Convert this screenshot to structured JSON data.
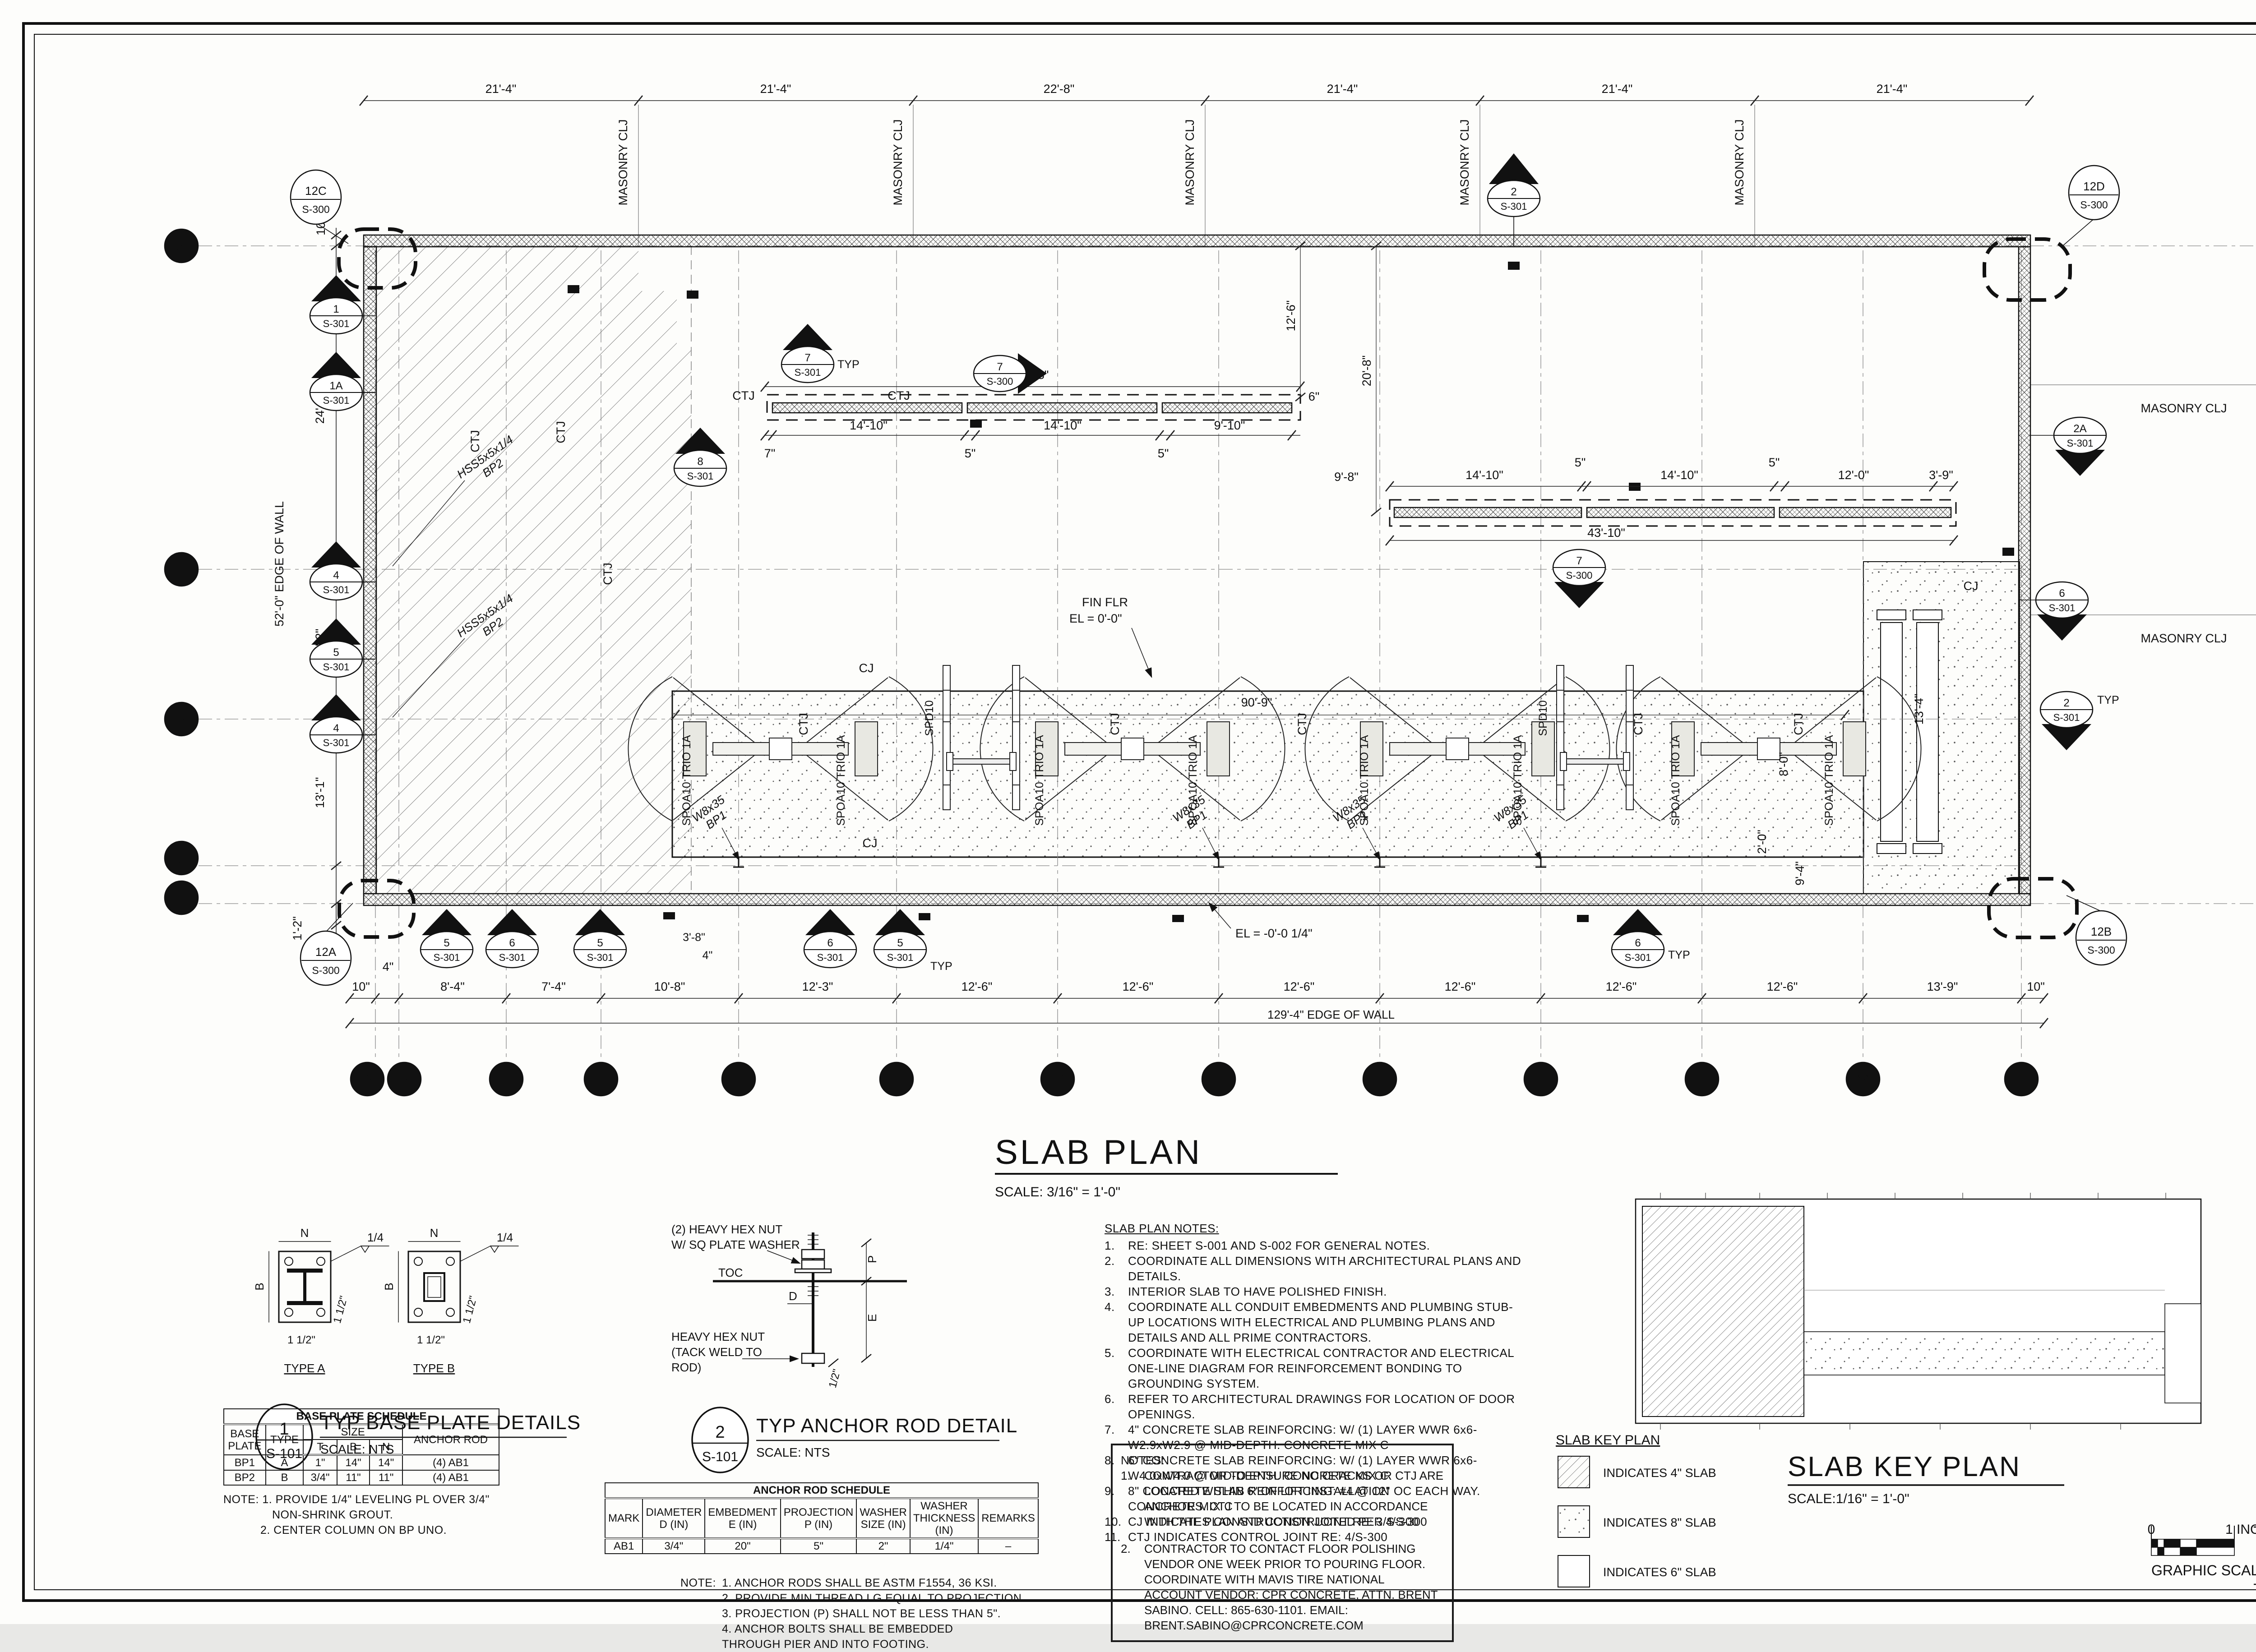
{
  "ti": {
    "plan": "SLAB PLAN",
    "plan_scale": "SCALE: 3/16\" = 1'-0\""
  },
  "td": [
    "21'-4\"",
    "21'-4\"",
    "22'-8\"",
    "21'-4\"",
    "21'-4\"",
    "21'-4\""
  ],
  "bd": [
    "10\"",
    "4\"",
    "8'-4\"",
    "7'-4\"",
    "10'-8\"",
    "12'-3\"",
    "12'-6\"",
    "12'-6\"",
    "12'-6\"",
    "12'-6\"",
    "12'-6\"",
    "12'-6\"",
    "13'-9\"",
    "10\""
  ],
  "bo": "129'-4\" EDGE OF WALL",
  "ld": [
    "10\"",
    "24'-9\"",
    "12'-2\"",
    "13'-1\"",
    "1'-2\"",
    "4\""
  ],
  "lo": "52'-0\" EDGE OF WALL",
  "rd": [
    "10'-8\"",
    "17'-8\"",
    "23'-8\""
  ],
  "cols": [
    "A",
    "B",
    "C",
    "D",
    "E",
    "F",
    "G",
    "H",
    "J",
    "K",
    "L",
    "M",
    "N"
  ],
  "rows": [
    "5",
    "4",
    "3",
    "2",
    "1"
  ],
  "lb": {
    "masonry": "MASONRY CLJ",
    "ctj": "CTJ",
    "cj": "CJ",
    "typ": "TYP",
    "fin1": "FIN FLR",
    "fin2": "EL = 0'-0\"",
    "elneg": "EL = -0'-0 1/4\"",
    "d909": "90'-9\"",
    "d208": "20'-8\"",
    "d126": "12'-6\"",
    "d98": "9'-8\"",
    "d134": "13'-4\"",
    "d80": "8'-0\"",
    "d20": "2'-0\"",
    "d94": "9'-4\"",
    "d38": "3'-8\"",
    "d4": "4\"",
    "d6": "6\"",
    "d7": "7\"",
    "w8": "W8x35",
    "bp1": "BP1",
    "hss": "HSS5x5x1/4",
    "bp2": "BP2",
    "spoa": "SPOA10 TRIO 1A",
    "spd": "SPD10"
  },
  "s1": {
    "all": "41'-8\"",
    "a": "14'-10\"",
    "b": "5\"",
    "c": "14'-10\"",
    "d": "5\"",
    "e": "9'-10\""
  },
  "s2": {
    "all": "43'-10\"",
    "a": "14'-10\"",
    "b": "5\"",
    "c": "14'-10\"",
    "d": "5\"",
    "e": "12'-0\"",
    "f": "3'-9\""
  },
  "mk": {
    "w1": {
      "n": "1",
      "s": "S-301"
    },
    "w1a": {
      "n": "1A",
      "s": "S-301"
    },
    "w4a": {
      "n": "4",
      "s": "S-301"
    },
    "w5": {
      "n": "5",
      "s": "S-301"
    },
    "w4b": {
      "n": "4",
      "s": "S-301"
    },
    "r2a": {
      "n": "2A",
      "s": "S-301"
    },
    "r6": {
      "n": "6",
      "s": "S-301"
    },
    "r2": {
      "n": "2",
      "s": "S-301"
    },
    "c7a": {
      "n": "7",
      "s": "S-301"
    },
    "c7b": {
      "n": "7",
      "s": "S-300"
    },
    "c7c": {
      "n": "7",
      "s": "S-300"
    },
    "c8": {
      "n": "8",
      "s": "S-301"
    },
    "n2": {
      "n": "2",
      "s": "S-301"
    },
    "b5a": {
      "n": "5",
      "s": "S-301"
    },
    "b6a": {
      "n": "6",
      "s": "S-301"
    },
    "b5b": {
      "n": "5",
      "s": "S-301"
    },
    "b6b": {
      "n": "6",
      "s": "S-301"
    },
    "b5c": {
      "n": "5",
      "s": "S-301"
    },
    "b6c": {
      "n": "6",
      "s": "S-301"
    },
    "c12a": {
      "n": "12A",
      "s": "S-300"
    },
    "c12b": {
      "n": "12B",
      "s": "S-300"
    },
    "c12c": {
      "n": "12C",
      "s": "S-300"
    },
    "c12d": {
      "n": "12D",
      "s": "S-300"
    }
  },
  "det": {
    "d1": {
      "num": "1",
      "s": "S-101",
      "title": "TYP BASE PLATE DETAILS",
      "scale": "SCALE:  NTS",
      "ta": "TYPE A",
      "tb": "TYPE B",
      "n": "N",
      "b": "B",
      "w": "1/4",
      "e1": "1 1/2\""
    },
    "d2": {
      "num": "2",
      "s": "S-101",
      "title": "TYP ANCHOR ROD DETAIL",
      "scale": "SCALE:  NTS",
      "l1": "(2) HEAVY HEX NUT",
      "l2": "W/ SQ PLATE WASHER",
      "toc": "TOC",
      "d": "D",
      "p": "P",
      "e": "E",
      "m1": "HEAVY HEX NUT",
      "m2": "(TACK WELD TO",
      "m3": "ROD)",
      "half": "1/2\""
    }
  },
  "sch": {
    "bp": {
      "title": "BASE PLATE SCHEDULE",
      "plate": "BASE\nPLATE",
      "type": "TYPE",
      "size": "SIZE",
      "t": "T",
      "b": "B",
      "n": "N",
      "rod": "ANCHOR ROD",
      "rows": [
        [
          "BP1",
          "A",
          "1\"",
          "14\"",
          "14\"",
          "(4) AB1"
        ],
        [
          "BP2",
          "B",
          "3/4\"",
          "11\"",
          "11\"",
          "(4) AB1"
        ]
      ],
      "n1": "NOTE:  1. PROVIDE 1/4\" LEVELING PL OVER 3/4\"",
      "n2": "NON-SHRINK GROUT.",
      "n3": "2. CENTER COLUMN ON BP UNO."
    },
    "ar": {
      "title": "ANCHOR ROD SCHEDULE",
      "h": [
        "MARK",
        "DIAMETER\nD (IN)",
        "EMBEDMENT\nE (IN)",
        "PROJECTION\nP (IN)",
        "WASHER\nSIZE (IN)",
        "WASHER\nTHICKNESS (IN)",
        "REMARKS"
      ],
      "row": [
        "AB1",
        "3/4\"",
        "20\"",
        "5\"",
        "2\"",
        "1/4\"",
        "–"
      ],
      "nl": "NOTE:",
      "notes": [
        "1. ANCHOR RODS SHALL BE ASTM F1554, 36 KSI.",
        "2. PROVIDE MIN THREAD LG EQUAL TO PROJECTION.",
        "3. PROJECTION (P) SHALL NOT BE LESS THAN 5\".",
        "4. ANCHOR BOLTS SHALL BE EMBEDDED THROUGH PIER AND INTO FOOTING."
      ]
    }
  },
  "sn": {
    "title": "SLAB PLAN NOTES:",
    "items": [
      {
        "n": "1.",
        "t": "RE: SHEET S-001 AND S-002 FOR GENERAL NOTES."
      },
      {
        "n": "2.",
        "t": "COORDINATE ALL DIMENSIONS WITH ARCHITECTURAL PLANS AND DETAILS."
      },
      {
        "n": "3.",
        "t": "INTERIOR SLAB TO HAVE POLISHED FINISH."
      },
      {
        "n": "4.",
        "t": "COORDINATE ALL CONDUIT EMBEDMENTS AND PLUMBING STUB-UP LOCATIONS WITH ELECTRICAL AND PLUMBING PLANS AND DETAILS AND ALL PRIME CONTRACTORS."
      },
      {
        "n": "5.",
        "t": "COORDINATE WITH ELECTRICAL CONTRACTOR AND ELECTRICAL ONE-LINE DIAGRAM FOR REINFORCEMENT BONDING TO GROUNDING SYSTEM."
      },
      {
        "n": "6.",
        "t": "REFER TO ARCHITECTURAL DRAWINGS FOR LOCATION OF DOOR OPENINGS."
      },
      {
        "n": "7.",
        "t": "4\" CONCRETE SLAB REINFORCING:  W/ (1) LAYER WWR 6x6-W2.9xW2.9 @ MID-DEPTH. CONCRETE MIX C"
      },
      {
        "n": "8.",
        "t": "6\" CONCRETE SLAB REINFORCING:  W/ (1) LAYER WWR 6x6-W4.0xW4.0 @ MID-DEPTH. CONCRETE MIX C"
      },
      {
        "n": "9.",
        "t": "8\" CONCRETE SLAB REINFORCING:  #4 @ 12\" OC EACH WAY. CONCRETE MIX C"
      },
      {
        "n": "10.",
        "t": "CJ INDICATES CONSTRUCTION JOINT RE: 3/S-300"
      },
      {
        "n": "11.",
        "t": "CTJ INDICATES CONTROL JOINT RE: 4/S-300"
      }
    ]
  },
  "nb": {
    "title": "NOTES:",
    "items": [
      {
        "n": "1.",
        "t": "CONTRACTOR TO ENSURE NO CRACKS OR CTJ ARE LOCATED WITHIN 6\" OF LIFT INSTALLATION ANCHORS. CTJ TO BE LOCATED IN ACCORDANCE WITH THE PLAN AND CONSTRUCTED PER 4/S-300"
      },
      {
        "n": "2.",
        "t": "CONTRACTOR TO CONTACT FLOOR POLISHING VENDOR ONE WEEK PRIOR TO POURING FLOOR. COORDINATE WITH MAVIS TIRE NATIONAL ACCOUNT VENDOR: CPR CONCRETE, ATTN. BRENT SABINO. CELL: 865-630-1101. EMAIL: BRENT.SABINO@CPRCONCRETE.COM"
      }
    ]
  },
  "kp": {
    "small": "SLAB KEY PLAN",
    "title": "SLAB KEY PLAN",
    "scale": "SCALE:1/16\" = 1'-0\"",
    "l4": "INDICATES 4\" SLAB",
    "l8": "INDICATES 8\" SLAB",
    "l6": "INDICATES 6\" SLAB"
  },
  "sh": {
    "label": "SHEET NO.:",
    "num": "S-101",
    "gs": "GRAPHIC SCALE",
    "g0": "0",
    "g1": "1 INCH"
  }
}
